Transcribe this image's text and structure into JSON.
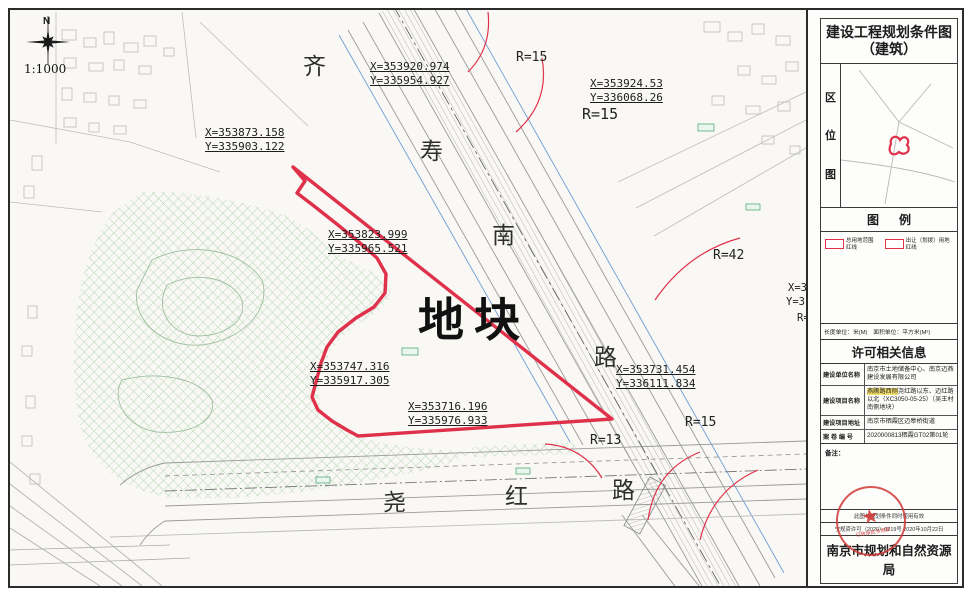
{
  "colors": {
    "boundary_red": "#e0314b",
    "hatch_green": "#8cc08f",
    "road_gray": "#9a9a9a",
    "line_blue": "#6f9cd4",
    "seal_red": "#d03a36"
  },
  "map": {
    "north_label": "N",
    "scale": "1:1000",
    "plot_label": "地块",
    "roads": {
      "qishounan": {
        "name": "齐寿南路",
        "chars": [
          "齐",
          "寿",
          "南",
          "路"
        ]
      },
      "yaohong": {
        "name": "尧红路",
        "chars": [
          "尧",
          "红",
          "路"
        ]
      }
    },
    "coordinates": [
      {
        "x": "X=353920.974",
        "y": "Y=335954.927"
      },
      {
        "x": "X=353924.53",
        "y": "Y=336068.26"
      },
      {
        "x": "X=353873.158",
        "y": "Y=335903.122"
      },
      {
        "x": "X=353823.999",
        "y": "Y=335965.521"
      },
      {
        "x": "X=353747.316",
        "y": "Y=335917.305"
      },
      {
        "x": "X=353716.196",
        "y": "Y=335976.933"
      },
      {
        "x": "X=353731.454",
        "y": "Y=336111.834"
      }
    ],
    "radius_labels": [
      "R=15",
      "R=15",
      "R=42",
      "R=15",
      "R=13"
    ],
    "edge_labels": [
      "X=3",
      "Y=3",
      "R="
    ]
  },
  "sidebar": {
    "title_line1": "建设工程规划条件图",
    "title_line2": "（建筑）",
    "location_label_chars": [
      "区",
      "位",
      "图"
    ],
    "legend": {
      "header": "图      例",
      "items": [
        "总用地范围红线",
        "出让（划拨）用地红线"
      ],
      "units_note": "长度单位：米(M)　面积单位：平方米(M²)"
    },
    "permit": {
      "header": "许可相关信息",
      "rows": [
        {
          "label": "建设单位名称",
          "value": "南京市土地储备中心、南京迈燕建设发展有限公司"
        },
        {
          "label": "建设项目名称",
          "highlight": "燕腾路西侧",
          "rest": "尧红路以东、迈红路以北（XC3050-05-25）（吴王村南侧地块）"
        },
        {
          "label": "建设项目地址",
          "value": "南京市栖霞区迈皋桥街道"
        },
        {
          "label": "案 卷 编 号",
          "value": "2020000813栖霞GT02第01轮"
        }
      ],
      "note_label": "备注："
    },
    "footer": {
      "note1": "此图与规划条件同时使用有效",
      "note2": "宁规资许可（2020）0219号  2020年10月22日",
      "bureau": "南京市规划和自然资源局",
      "seal_text": "行政审批专用章"
    }
  }
}
